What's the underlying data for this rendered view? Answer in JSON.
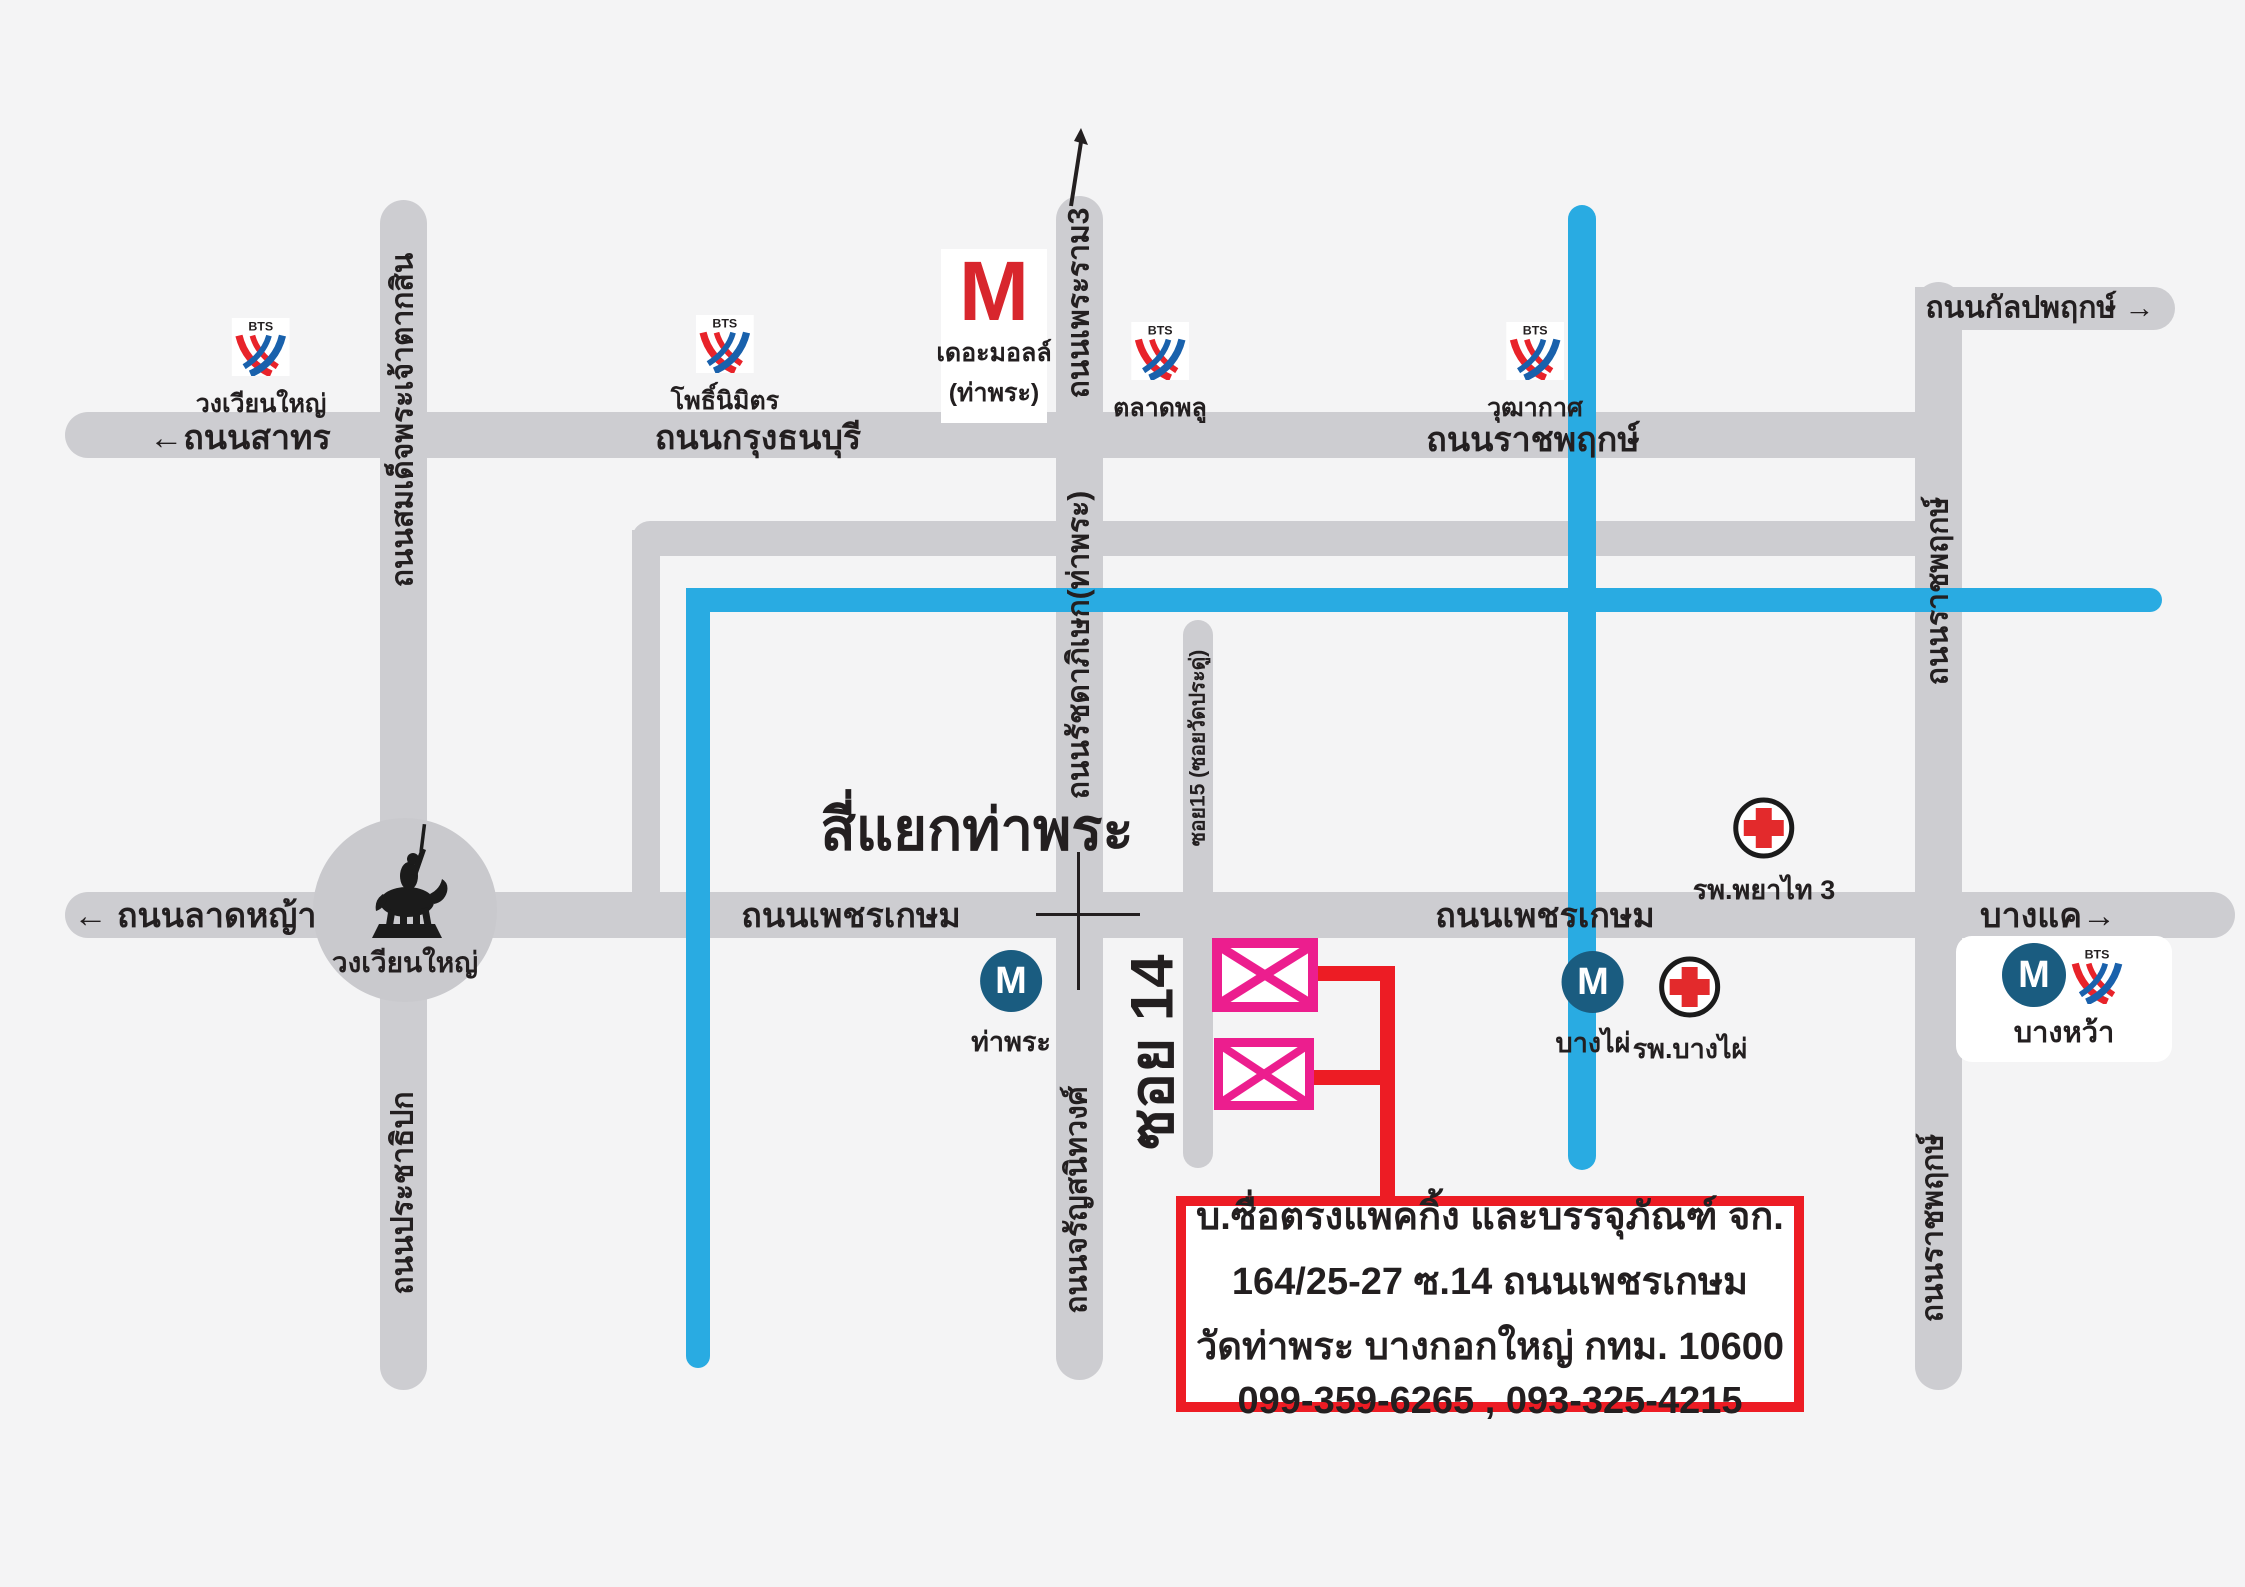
{
  "roads": {
    "h": {
      "sathorn": {
        "arrow": "←",
        "text": "ถนนสาทร"
      },
      "krungthonburi": {
        "text": "ถนนกรุงธนบุรี"
      },
      "ratchaphruek": {
        "text": "ถนนราชพฤกษ์"
      },
      "kalpapruek": {
        "text": "ถนนกัลปพฤกษ์",
        "arrow": "→"
      },
      "latya": {
        "arrow": "←",
        "text": "ถนนลาดหญ้า"
      },
      "phetkasem_left": {
        "text": "ถนนเพชรเกษม"
      },
      "phetkasem_right": {
        "text": "ถนนเพชรเกษม"
      },
      "bangkhae": {
        "text": "บางแค",
        "arrow": "→"
      }
    },
    "v": {
      "taksin": {
        "text": "ถนนสมเด็จพระเจ้าตากสิน"
      },
      "prachathipok": {
        "text": "ถนนประชาธิปก"
      },
      "rama3": {
        "text": "ถนนเพระราม3"
      },
      "ratchadapisek": {
        "text": "ถนนรัชดาภิเษก(ท่าพระ)"
      },
      "charansanitwong": {
        "text": "ถนนจรัญสนิทวงศ์"
      },
      "soi15": {
        "text": "ซอย15 (ซอยวัดประดู่)"
      },
      "ratchaphruek_upper": {
        "text": "ถนนราชพฤกษ์"
      },
      "ratchaphruek_lower": {
        "text": "ถนนราชพฤกษ์"
      },
      "soi14": {
        "text": "ซอย 14"
      }
    }
  },
  "landmarks": {
    "thaphra_intersection": "สี่แยกท่าพระ",
    "wongwianyai_roundabout": "วงเวียนใหญ่"
  },
  "bts": {
    "brand": "BTS",
    "wongwianyai": "วงเวียนใหญ่",
    "phonimit": "โพธิ์นิมิตร",
    "talatphlu": "ตลาดพลู",
    "wutthakat": "วุฒากาศ"
  },
  "the_mall": {
    "letter": "M",
    "line1": "เดอะมอลล์",
    "line2": "(ท่าพระ)"
  },
  "mrt": {
    "letter": "M",
    "thaphra": "ท่าพระ",
    "bangphai": "บางไผ่",
    "bangwa": "บางหว้า"
  },
  "hospitals": {
    "phyathai3": "รพ.พยาไท 3",
    "bangphai": "รพ.บางไผ่"
  },
  "info_box": {
    "lines": [
      "บ.ซื่อตรงแพคกิ้ง และบรรจุภัณฑ์ จก.",
      "164/25-27 ซ.14 ถนนเพชรเกษม",
      "วัดท่าพระ บางกอกใหญ่ กทม. 10600",
      "099-359-6265 , 093-325-4215"
    ]
  },
  "colors": {
    "background": "#f4f4f5",
    "road_gray": "#cdcdd1",
    "canal_blue": "#29abe2",
    "route_red": "#ed1c24",
    "highlight_magenta": "#ec1e8e",
    "mrt_navy": "#1a5c80",
    "bts_red": "#e8232a",
    "bts_blue": "#1961ac",
    "mall_red": "#d8262d",
    "text_black": "#231f20"
  }
}
